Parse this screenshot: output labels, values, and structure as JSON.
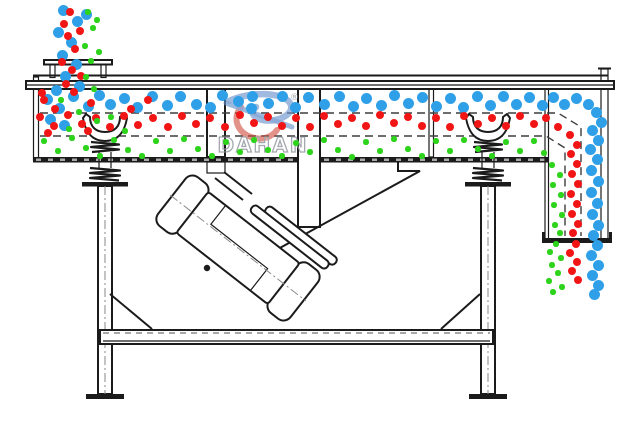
{
  "brand": {
    "logo_text": "DAHAN",
    "registered_mark": "®",
    "logo_red": "#cf4a38",
    "logo_blue": "#6a93cc",
    "logo_text_color": "#8d949b"
  },
  "colors": {
    "line": "#1b1b1b",
    "gray": "#777777",
    "bg": "#ffffff"
  },
  "particles": {
    "blue": {
      "name": "coarse-particles",
      "color": "#2fa0e8",
      "radius": 5.5,
      "points": [
        [
          63,
          10
        ],
        [
          77,
          21
        ],
        [
          58,
          32
        ],
        [
          71,
          42
        ],
        [
          86,
          14
        ],
        [
          62,
          55
        ],
        [
          76,
          64
        ],
        [
          65,
          76
        ],
        [
          79,
          86
        ],
        [
          56,
          90
        ],
        [
          47,
          99
        ],
        [
          59,
          108
        ],
        [
          73,
          96
        ],
        [
          88,
          106
        ],
        [
          99,
          95
        ],
        [
          110,
          104
        ],
        [
          50,
          119
        ],
        [
          64,
          125
        ],
        [
          124,
          98
        ],
        [
          137,
          107
        ],
        [
          152,
          96
        ],
        [
          167,
          105
        ],
        [
          180,
          96
        ],
        [
          196,
          104
        ],
        [
          210,
          107
        ],
        [
          222,
          95
        ],
        [
          238,
          101
        ],
        [
          252,
          96
        ],
        [
          251,
          108
        ],
        [
          268,
          103
        ],
        [
          282,
          96
        ],
        [
          295,
          107
        ],
        [
          308,
          97
        ],
        [
          324,
          104
        ],
        [
          339,
          96
        ],
        [
          353,
          106
        ],
        [
          366,
          98
        ],
        [
          381,
          105
        ],
        [
          394,
          95
        ],
        [
          408,
          103
        ],
        [
          422,
          97
        ],
        [
          436,
          106
        ],
        [
          450,
          98
        ],
        [
          463,
          107
        ],
        [
          477,
          96
        ],
        [
          490,
          105
        ],
        [
          503,
          96
        ],
        [
          516,
          104
        ],
        [
          529,
          97
        ],
        [
          542,
          105
        ],
        [
          553,
          97
        ],
        [
          564,
          104
        ],
        [
          576,
          98
        ],
        [
          588,
          104
        ],
        [
          596,
          112
        ],
        [
          601,
          122
        ],
        [
          592,
          130
        ],
        [
          598,
          140
        ],
        [
          590,
          149
        ],
        [
          597,
          159
        ],
        [
          591,
          170
        ],
        [
          598,
          181
        ],
        [
          591,
          192
        ],
        [
          597,
          203
        ],
        [
          592,
          214
        ],
        [
          598,
          225
        ],
        [
          593,
          235
        ],
        [
          597,
          245
        ],
        [
          591,
          255
        ],
        [
          598,
          265
        ],
        [
          592,
          275
        ],
        [
          598,
          285
        ],
        [
          594,
          294
        ]
      ]
    },
    "red": {
      "name": "medium-particles",
      "color": "#f21515",
      "radius": 4,
      "points": [
        [
          70,
          12
        ],
        [
          64,
          24
        ],
        [
          80,
          31
        ],
        [
          68,
          36
        ],
        [
          75,
          49
        ],
        [
          62,
          62
        ],
        [
          72,
          70
        ],
        [
          81,
          76
        ],
        [
          66,
          84
        ],
        [
          74,
          92
        ],
        [
          42,
          93
        ],
        [
          44,
          100
        ],
        [
          55,
          109
        ],
        [
          91,
          103
        ],
        [
          131,
          109
        ],
        [
          148,
          100
        ],
        [
          40,
          117
        ],
        [
          54,
          126
        ],
        [
          68,
          115
        ],
        [
          82,
          124
        ],
        [
          96,
          118
        ],
        [
          110,
          127
        ],
        [
          124,
          116
        ],
        [
          138,
          125
        ],
        [
          153,
          118
        ],
        [
          168,
          127
        ],
        [
          182,
          116
        ],
        [
          196,
          124
        ],
        [
          210,
          118
        ],
        [
          225,
          127
        ],
        [
          240,
          115
        ],
        [
          254,
          123
        ],
        [
          268,
          117
        ],
        [
          282,
          126
        ],
        [
          296,
          118
        ],
        [
          310,
          127
        ],
        [
          324,
          116
        ],
        [
          338,
          124
        ],
        [
          352,
          118
        ],
        [
          366,
          126
        ],
        [
          380,
          115
        ],
        [
          394,
          123
        ],
        [
          408,
          117
        ],
        [
          422,
          126
        ],
        [
          436,
          118
        ],
        [
          450,
          127
        ],
        [
          464,
          116
        ],
        [
          478,
          124
        ],
        [
          492,
          118
        ],
        [
          506,
          126
        ],
        [
          520,
          116
        ],
        [
          534,
          124
        ],
        [
          546,
          118
        ],
        [
          48,
          133
        ],
        [
          88,
          131
        ],
        [
          558,
          127
        ],
        [
          570,
          135
        ],
        [
          577,
          145
        ],
        [
          571,
          154
        ],
        [
          577,
          164
        ],
        [
          572,
          174
        ],
        [
          578,
          184
        ],
        [
          571,
          194
        ],
        [
          577,
          204
        ],
        [
          572,
          214
        ],
        [
          578,
          224
        ],
        [
          573,
          233
        ],
        [
          576,
          244
        ],
        [
          570,
          253
        ],
        [
          577,
          262
        ],
        [
          572,
          271
        ],
        [
          578,
          280
        ]
      ]
    },
    "green": {
      "name": "fine-particles",
      "color": "#2ed31c",
      "radius": 2.6,
      "points": [
        [
          88,
          12
        ],
        [
          93,
          28
        ],
        [
          85,
          46
        ],
        [
          91,
          61
        ],
        [
          86,
          77
        ],
        [
          94,
          89
        ],
        [
          97,
          20
        ],
        [
          99,
          52
        ],
        [
          61,
          100
        ],
        [
          79,
          112
        ],
        [
          97,
          121
        ],
        [
          69,
          129
        ],
        [
          111,
          117
        ],
        [
          125,
          131
        ],
        [
          44,
          141
        ],
        [
          58,
          151
        ],
        [
          72,
          138
        ],
        [
          86,
          148
        ],
        [
          100,
          156
        ],
        [
          114,
          140
        ],
        [
          128,
          150
        ],
        [
          142,
          156
        ],
        [
          156,
          141
        ],
        [
          170,
          151
        ],
        [
          184,
          139
        ],
        [
          198,
          149
        ],
        [
          212,
          156
        ],
        [
          226,
          142
        ],
        [
          240,
          152
        ],
        [
          254,
          140
        ],
        [
          268,
          150
        ],
        [
          282,
          156
        ],
        [
          296,
          143
        ],
        [
          310,
          152
        ],
        [
          324,
          140
        ],
        [
          338,
          150
        ],
        [
          352,
          157
        ],
        [
          366,
          142
        ],
        [
          380,
          151
        ],
        [
          394,
          139
        ],
        [
          408,
          149
        ],
        [
          422,
          156
        ],
        [
          436,
          141
        ],
        [
          450,
          151
        ],
        [
          464,
          140
        ],
        [
          478,
          149
        ],
        [
          492,
          156
        ],
        [
          506,
          142
        ],
        [
          520,
          151
        ],
        [
          534,
          141
        ],
        [
          544,
          153
        ],
        [
          552,
          165
        ],
        [
          560,
          175
        ],
        [
          553,
          185
        ],
        [
          561,
          195
        ],
        [
          554,
          205
        ],
        [
          562,
          215
        ],
        [
          555,
          225
        ],
        [
          560,
          233
        ],
        [
          556,
          244
        ],
        [
          550,
          252
        ],
        [
          561,
          258
        ],
        [
          552,
          265
        ],
        [
          558,
          273
        ],
        [
          549,
          281
        ],
        [
          562,
          287
        ],
        [
          553,
          292
        ]
      ]
    }
  }
}
